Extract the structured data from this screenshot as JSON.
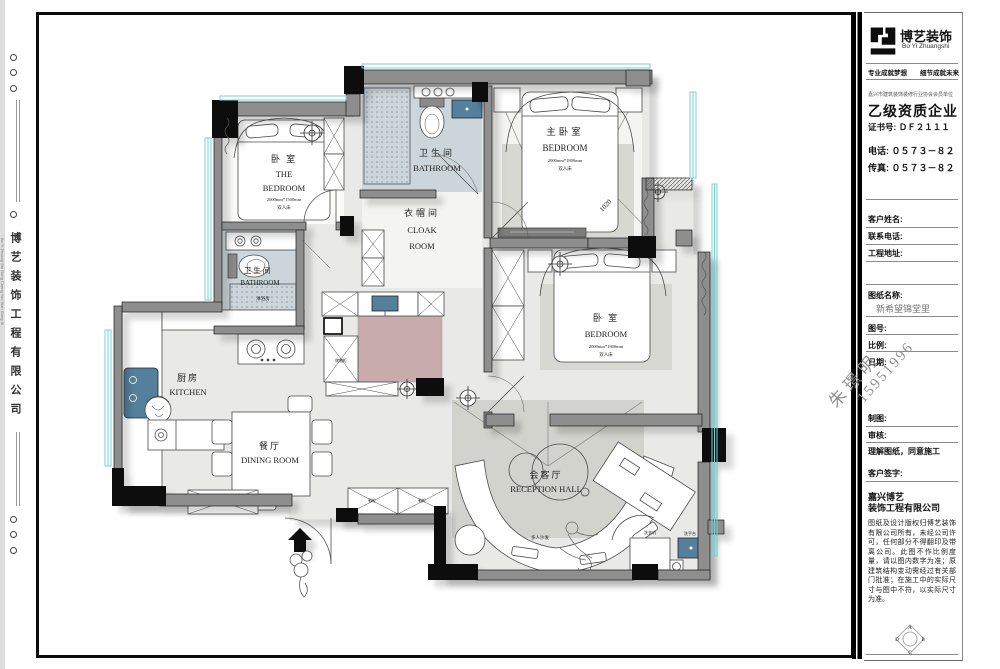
{
  "left_strip": {
    "company_vertical": "博艺装饰工程有限公司",
    "company_vertical_en": "Bo Yi Zhuang Shi Gong Cheng You Xian Gong Si"
  },
  "title_block": {
    "logo_cn": "博艺装饰",
    "logo_en": "Bo Yi Zhuangshi",
    "slogan_left": "专业成就梦想",
    "slogan_right": "细节成就未来",
    "fine_print": "嘉兴市建筑装饰装修行业协会会员单位",
    "grade": "乙级资质企业",
    "cert": "证书号: ＤＦ２１１１",
    "phone": "电话: ０５７３－８２",
    "fax": "传真: ０５７３－８２",
    "customer_label": "客户姓名:",
    "contact_label": "联系电话:",
    "address_label": "工程地址:",
    "drawing_name_label": "图纸名称:",
    "drawing_name": "新希望锦堂里",
    "drawing_no_label": "图号:",
    "scale_label": "比例:",
    "date_label": "日期:",
    "watermark_name": "朱璟明",
    "watermark_phone": "15951996",
    "draft_label": "制图:",
    "review_label": "审核:",
    "agree": "理解图纸，同意施工",
    "sign_label": "客户签字:",
    "company1": "嘉兴博艺",
    "company2": "装饰工程有限公司",
    "disclaimer": "图纸及设计版权归博艺装饰有限公司所有，未经公司许可，任何部分不得翻印及带离公司。此图不作比例度量，请以图内数字为准；原建筑结构变动需经过有关部门批准；在施工中的实际尺寸与图中不符，以实际尺寸为准。"
  },
  "floor_plan": {
    "labels": {
      "bedroom1_cn": "卧 室",
      "bedroom1_en1": "THE",
      "bedroom1_en2": "BEDROOM",
      "bedroom1_size": "2000mm*1500mm",
      "bedroom1_bed": "双人床",
      "bathroom1_cn": "卫生间",
      "bathroom1_en": "BATHROOM",
      "master_cn": "主卧室",
      "master_en": "BEDROOM",
      "master_size": "2000mm*1800mm",
      "master_bed": "双人床",
      "cloak_cn": "衣帽间",
      "cloak_en1": "CLOAK",
      "cloak_en2": "ROOM",
      "bathroom2_cn": "卫生间",
      "bathroom2_en": "BATHROOM",
      "bathroom2_shower": "淋浴房",
      "kitchen_cn": "厨房",
      "kitchen_en": "KITCHEN",
      "dining_cn": "餐厅",
      "dining_en": "DINING ROOM",
      "bedroom2_cn": "卧 室",
      "bedroom2_en": "BEDROOM",
      "bedroom2_size": "2000mm*1800mm",
      "bedroom2_bed": "双人床",
      "hall_cn": "会客厅",
      "hall_en": "RECEPTION HALL",
      "sofa": "多人沙发",
      "washer": "洗衣机",
      "basin": "洗手台",
      "dim": "1020",
      "shoe1": "鞋柜",
      "shoe2": "鞋柜",
      "storage": "储物柜"
    }
  },
  "colors": {
    "wall": "#8e8e8e",
    "window": "#7ccfd3",
    "bath_floor": "#ccd6da",
    "pink_floor": "#c8abad",
    "fixture_blue": "#54809b"
  }
}
